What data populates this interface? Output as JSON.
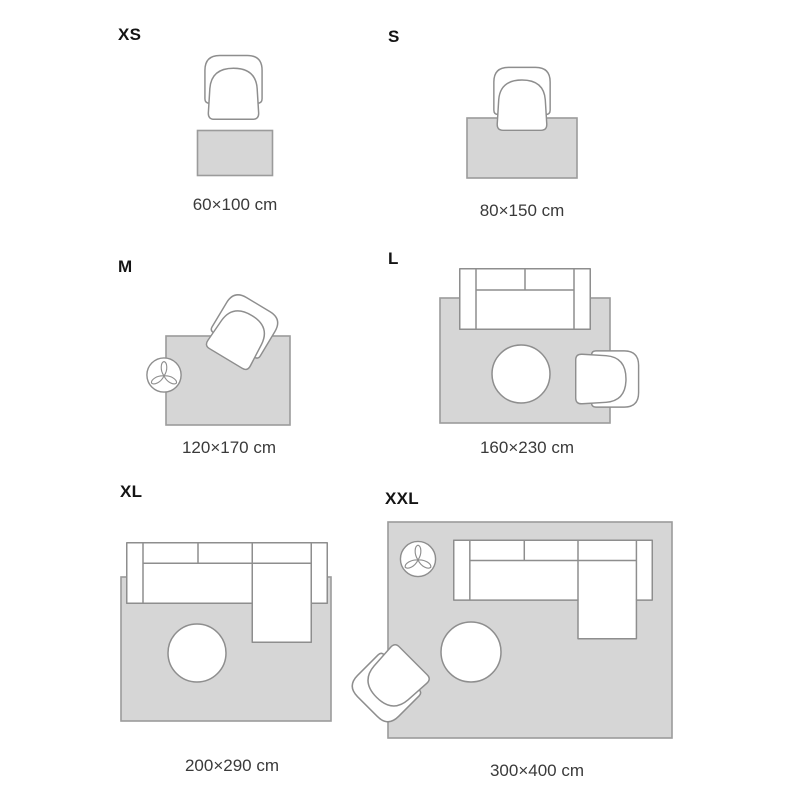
{
  "theme": {
    "background": "#ffffff",
    "rug_fill": "#d6d6d6",
    "rug_stroke": "#9b9b9b",
    "furniture_fill": "#ffffff",
    "furniture_stroke": "#8e8e8e",
    "label_color": "#141414",
    "dimension_color": "#3a3a3a"
  },
  "sizes": [
    {
      "label": "XS",
      "dimensions": "60×100 cm",
      "rug_size_cm": "60×100",
      "furniture": [
        "armchair"
      ]
    },
    {
      "label": "S",
      "dimensions": "80×150 cm",
      "rug_size_cm": "80×150",
      "furniture": [
        "armchair"
      ]
    },
    {
      "label": "M",
      "dimensions": "120×170 cm",
      "rug_size_cm": "120×170",
      "furniture": [
        "armchair",
        "plant"
      ]
    },
    {
      "label": "L",
      "dimensions": "160×230 cm",
      "rug_size_cm": "160×230",
      "furniture": [
        "sofa",
        "pouf",
        "armchair"
      ]
    },
    {
      "label": "XL",
      "dimensions": "200×290 cm",
      "rug_size_cm": "200×290",
      "furniture": [
        "corner-sofa",
        "pouf"
      ]
    },
    {
      "label": "XXL",
      "dimensions": "300×400 cm",
      "rug_size_cm": "300×400",
      "furniture": [
        "plant",
        "corner-sofa",
        "pouf",
        "armchair"
      ]
    }
  ]
}
